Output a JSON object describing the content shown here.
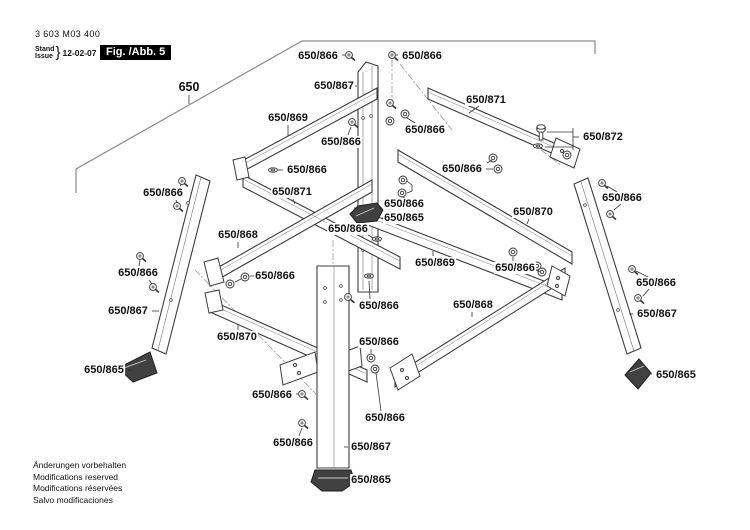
{
  "header": {
    "part_number": "3 603 M03 400",
    "revision_word_1": "Stand",
    "revision_word_2": "Issue",
    "revision_brace": "}",
    "revision_date": "12-02-07",
    "figure_label": "Fig. /Abb. 5"
  },
  "footer": {
    "lines": [
      "Änderungen vorbehalten",
      "Modifications reserved",
      "Modifications réservées",
      "Salvo modificaciones"
    ]
  },
  "colors": {
    "part_line": "#3c3c3c",
    "light_line": "#8a8a8a",
    "leader_line": "#333333",
    "label_text": "#111111",
    "figure_bg": "#000000",
    "figure_fg": "#ffffff",
    "foot_fill": "#414141"
  },
  "labels": [
    {
      "text": "650",
      "x": 189,
      "y": 87,
      "big": true
    },
    {
      "text": "650/866",
      "x": 318,
      "y": 56
    },
    {
      "text": "650/866",
      "x": 422,
      "y": 56
    },
    {
      "text": "650/867",
      "x": 334,
      "y": 86
    },
    {
      "text": "650/869",
      "x": 288,
      "y": 118
    },
    {
      "text": "650/871",
      "x": 486,
      "y": 100
    },
    {
      "text": "650/866",
      "x": 341,
      "y": 142
    },
    {
      "text": "650/866",
      "x": 425,
      "y": 130
    },
    {
      "text": "650/872",
      "x": 603,
      "y": 137
    },
    {
      "text": "650/866",
      "x": 622,
      "y": 198
    },
    {
      "text": "650/866",
      "x": 307,
      "y": 170
    },
    {
      "text": "650/871",
      "x": 292,
      "y": 192
    },
    {
      "text": "650/866",
      "x": 163,
      "y": 193
    },
    {
      "text": "650/866",
      "x": 462,
      "y": 169
    },
    {
      "text": "650/870",
      "x": 533,
      "y": 212
    },
    {
      "text": "650/866",
      "x": 404,
      "y": 204
    },
    {
      "text": "650/865",
      "x": 404,
      "y": 218
    },
    {
      "text": "650/866",
      "x": 348,
      "y": 229
    },
    {
      "text": "650/868",
      "x": 238,
      "y": 235
    },
    {
      "text": "650/869",
      "x": 435,
      "y": 263
    },
    {
      "text": "650/866",
      "x": 138,
      "y": 273
    },
    {
      "text": "650/866",
      "x": 275,
      "y": 276
    },
    {
      "text": "650/866",
      "x": 515,
      "y": 268
    },
    {
      "text": "650/868",
      "x": 473,
      "y": 305
    },
    {
      "text": "650/866",
      "x": 379,
      "y": 306
    },
    {
      "text": "650/866",
      "x": 656,
      "y": 283
    },
    {
      "text": "650/867",
      "x": 128,
      "y": 311
    },
    {
      "text": "650/867",
      "x": 657,
      "y": 314
    },
    {
      "text": "650/870",
      "x": 237,
      "y": 337
    },
    {
      "text": "650/866",
      "x": 379,
      "y": 342
    },
    {
      "text": "650/865",
      "x": 104,
      "y": 370
    },
    {
      "text": "650/865",
      "x": 676,
      "y": 375
    },
    {
      "text": "650/866",
      "x": 272,
      "y": 395
    },
    {
      "text": "650/866",
      "x": 385,
      "y": 418
    },
    {
      "text": "650/866",
      "x": 293,
      "y": 443
    },
    {
      "text": "650/867",
      "x": 371,
      "y": 447
    },
    {
      "text": "650/865",
      "x": 371,
      "y": 480
    }
  ],
  "leader_lines": [
    [
      189,
      95,
      189,
      104
    ],
    [
      342,
      55,
      345,
      55
    ],
    [
      396,
      55,
      398,
      55
    ],
    [
      353,
      86,
      357,
      86
    ],
    [
      288,
      125,
      288,
      136
    ],
    [
      479,
      106,
      469,
      113
    ],
    [
      348,
      135,
      351,
      127
    ],
    [
      415,
      123,
      407,
      118
    ],
    [
      547,
      132,
      573,
      132
    ],
    [
      545,
      147,
      573,
      147
    ],
    [
      573,
      128,
      573,
      150
    ],
    [
      573,
      137,
      579,
      137
    ],
    [
      607,
      186,
      617,
      192
    ],
    [
      614,
      210,
      621,
      204
    ],
    [
      278,
      170,
      283,
      170
    ],
    [
      293,
      199,
      295,
      204
    ],
    [
      180,
      186,
      182,
      184
    ],
    [
      176,
      200,
      177,
      203
    ],
    [
      486,
      169,
      493,
      169
    ],
    [
      487,
      163,
      492,
      160
    ],
    [
      529,
      219,
      527,
      224
    ],
    [
      404,
      199,
      404,
      196
    ],
    [
      407,
      181,
      412,
      185
    ],
    [
      412,
      185,
      412,
      191
    ],
    [
      407,
      193,
      412,
      191
    ],
    [
      382,
      218,
      386,
      218
    ],
    [
      368,
      235,
      373,
      238
    ],
    [
      238,
      242,
      238,
      248
    ],
    [
      433,
      256,
      433,
      251
    ],
    [
      139,
      266,
      140,
      260
    ],
    [
      149,
      280,
      152,
      284
    ],
    [
      250,
      276,
      256,
      276
    ],
    [
      241,
      279,
      235,
      282
    ],
    [
      513,
      261,
      513,
      257
    ],
    [
      536,
      270,
      540,
      272
    ],
    [
      472,
      312,
      472,
      317
    ],
    [
      355,
      303,
      352,
      300
    ],
    [
      370,
      299,
      369,
      281
    ],
    [
      636,
      271,
      650,
      278
    ],
    [
      643,
      296,
      650,
      288
    ],
    [
      152,
      311,
      159,
      311
    ],
    [
      629,
      314,
      633,
      314
    ],
    [
      238,
      330,
      238,
      324
    ],
    [
      371,
      349,
      371,
      353
    ],
    [
      128,
      370,
      132,
      370
    ],
    [
      649,
      374,
      652,
      374
    ],
    [
      296,
      394,
      298,
      394
    ],
    [
      381,
      411,
      376,
      373
    ],
    [
      299,
      436,
      302,
      428
    ],
    [
      344,
      447,
      348,
      447
    ],
    [
      345,
      480,
      351,
      480
    ]
  ],
  "fasteners": [
    {
      "type": "screw",
      "x": 349,
      "y": 55
    },
    {
      "type": "screw",
      "x": 392,
      "y": 55
    },
    {
      "type": "screw",
      "x": 390,
      "y": 103
    },
    {
      "type": "nut",
      "x": 405,
      "y": 114
    },
    {
      "type": "nut",
      "x": 390,
      "y": 121
    },
    {
      "type": "screw",
      "x": 352,
      "y": 122
    },
    {
      "type": "nut",
      "x": 567,
      "y": 155
    },
    {
      "type": "bolt",
      "x": 541,
      "y": 128
    },
    {
      "type": "washer",
      "x": 538,
      "y": 146
    },
    {
      "type": "screw",
      "x": 602,
      "y": 183
    },
    {
      "type": "screw",
      "x": 610,
      "y": 214
    },
    {
      "type": "washer",
      "x": 273,
      "y": 170
    },
    {
      "type": "screw",
      "x": 182,
      "y": 181
    },
    {
      "type": "screw",
      "x": 177,
      "y": 206
    },
    {
      "type": "nut",
      "x": 493,
      "y": 158
    },
    {
      "type": "nut",
      "x": 498,
      "y": 169
    },
    {
      "type": "nut",
      "x": 403,
      "y": 180
    },
    {
      "type": "nut",
      "x": 402,
      "y": 193
    },
    {
      "type": "washer",
      "x": 377,
      "y": 239
    },
    {
      "type": "screw",
      "x": 140,
      "y": 256
    },
    {
      "type": "screw",
      "x": 153,
      "y": 287
    },
    {
      "type": "nut",
      "x": 245,
      "y": 277
    },
    {
      "type": "nut",
      "x": 230,
      "y": 284
    },
    {
      "type": "nut",
      "x": 513,
      "y": 252
    },
    {
      "type": "nut",
      "x": 537,
      "y": 266
    },
    {
      "type": "nut",
      "x": 542,
      "y": 272
    },
    {
      "type": "washer",
      "x": 369,
      "y": 276
    },
    {
      "type": "screw",
      "x": 348,
      "y": 297
    },
    {
      "type": "screw",
      "x": 632,
      "y": 269
    },
    {
      "type": "screw",
      "x": 638,
      "y": 298
    },
    {
      "type": "nut",
      "x": 371,
      "y": 358
    },
    {
      "type": "nut",
      "x": 375,
      "y": 369
    },
    {
      "type": "screw",
      "x": 302,
      "y": 394
    },
    {
      "type": "screw",
      "x": 302,
      "y": 423
    }
  ]
}
